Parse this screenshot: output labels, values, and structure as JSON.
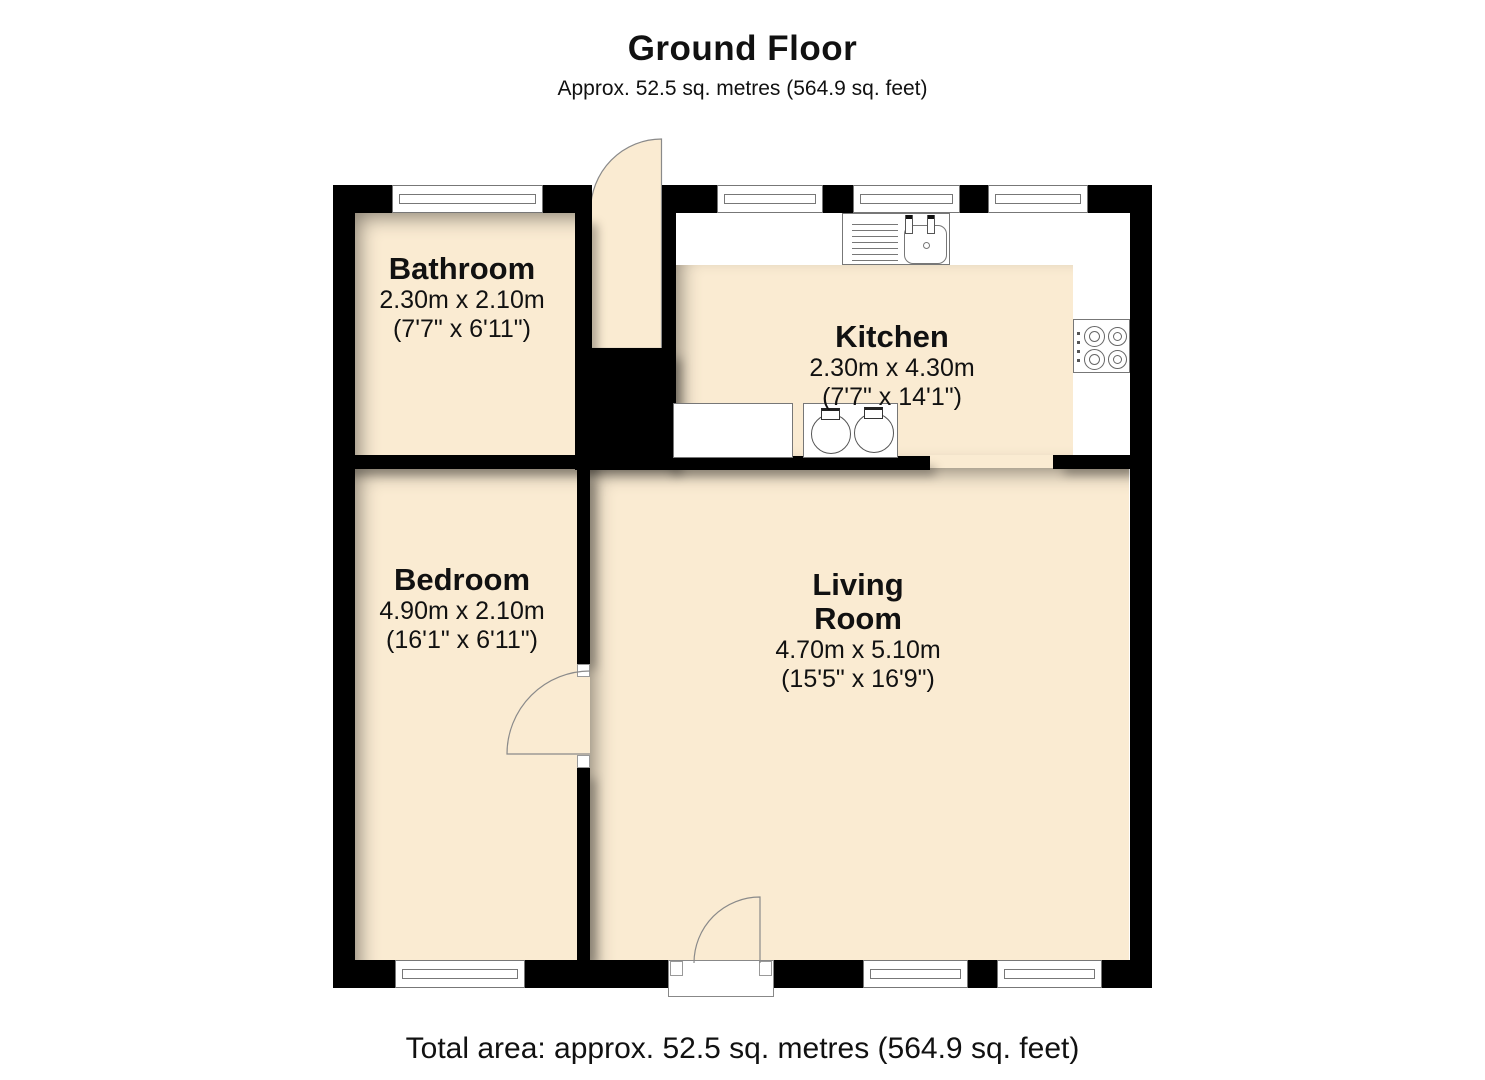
{
  "header": {
    "title": "Ground Floor",
    "subtitle": "Approx. 52.5 sq. metres (564.9 sq. feet)"
  },
  "footer": {
    "total_area": "Total area: approx. 52.5 sq. metres (564.9 sq. feet)"
  },
  "rooms": [
    {
      "id": "bathroom",
      "name": "Bathroom",
      "dims_metric": "2.30m x 2.10m",
      "dims_imperial": "(7'7\" x 6'11\")"
    },
    {
      "id": "kitchen",
      "name": "Kitchen",
      "dims_metric": "2.30m x 4.30m",
      "dims_imperial": "(7'7\" x 14'1\")"
    },
    {
      "id": "bedroom",
      "name": "Bedroom",
      "dims_metric": "4.90m x 2.10m",
      "dims_imperial": "(16'1\" x 6'11\")"
    },
    {
      "id": "living_room",
      "name": "Living Room",
      "name_lines": [
        "Living",
        "Room"
      ],
      "dims_metric": "4.70m x 5.10m",
      "dims_imperial": "(15'5\" x 16'9\")"
    }
  ],
  "colors": {
    "floor": "#FAEBD2",
    "wall": "#000000",
    "fixture_line": "#777777",
    "text": "#111111"
  }
}
